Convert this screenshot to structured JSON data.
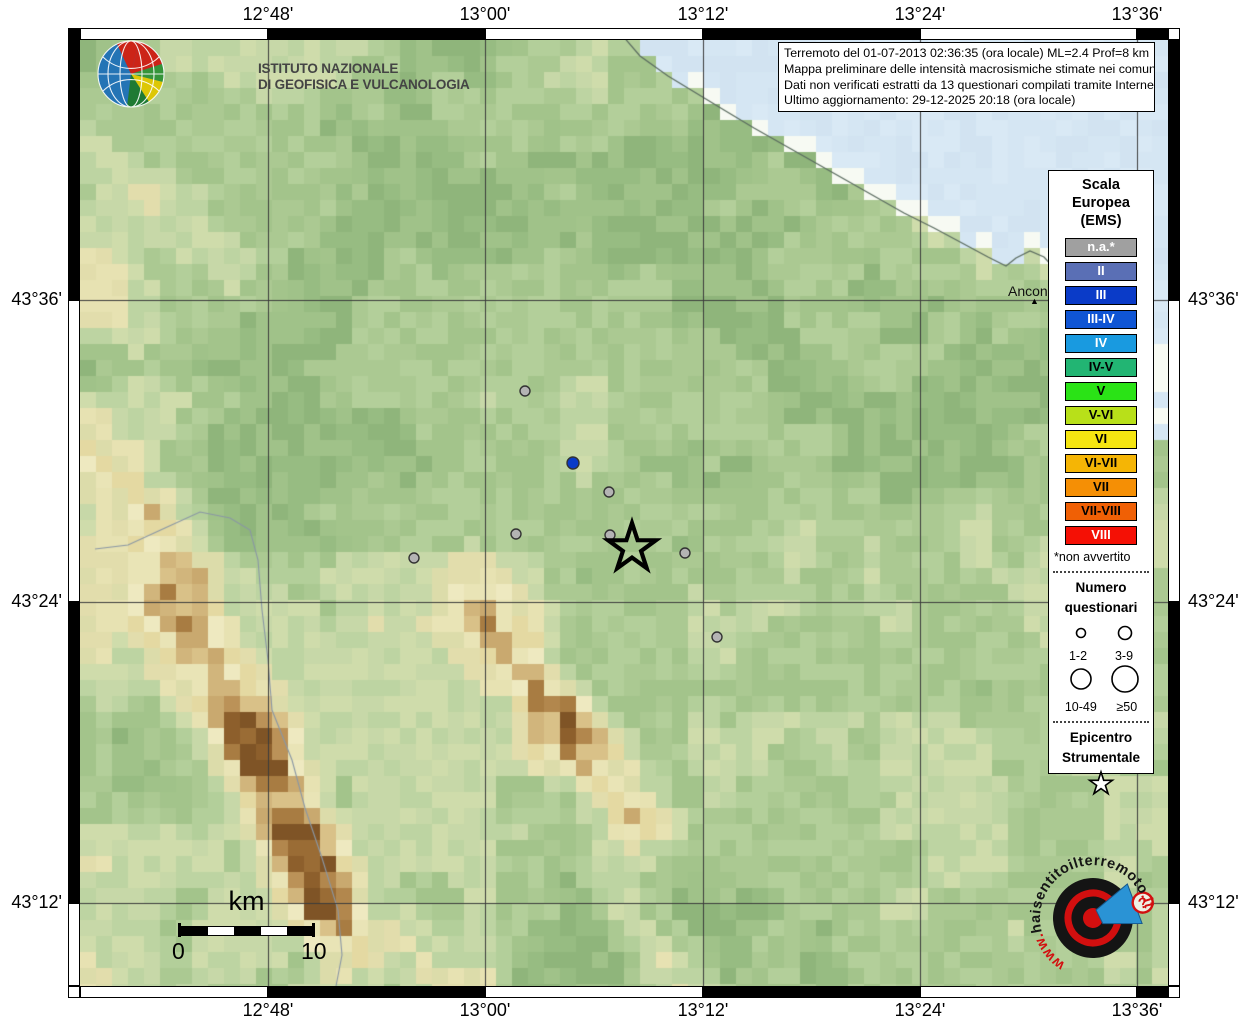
{
  "ingv": {
    "name_line1": "ISTITUTO NAZIONALE",
    "name_line2": "DI GEOFISICA E VULCANOLOGIA"
  },
  "title_box": {
    "lines": [
      "Terremoto del 01-07-2013 02:36:35 (ora locale) ML=2.4 Prof=8 km",
      "Mappa preliminare delle intensità macrosismiche stimate nei comuni",
      "Dati non verificati estratti da 13 questionari compilati tramite Internet.",
      "Ultimo aggiornamento: 29-12-2025 20:18 (ora locale)"
    ]
  },
  "axes": {
    "top": [
      "12°48'",
      "13°00'",
      "13°12'",
      "13°24'",
      "13°36'"
    ],
    "bottom": [
      "12°48'",
      "13°00'",
      "13°12'",
      "13°24'",
      "13°36'"
    ],
    "left": [
      "43°36'",
      "43°24'",
      "43°12'"
    ],
    "right": [
      "43°36'",
      "43°24'",
      "43°12'"
    ]
  },
  "legend": {
    "scale_title": [
      "Scala",
      "Europea",
      "(EMS)"
    ],
    "classes": [
      {
        "label": "n.a.*",
        "color": "#a0a0a0",
        "text": "#ffffff"
      },
      {
        "label": "II",
        "color": "#5a6fb5",
        "text": "#ffffff"
      },
      {
        "label": "III",
        "color": "#0a3bc8",
        "text": "#ffffff"
      },
      {
        "label": "III-IV",
        "color": "#0f55d4",
        "text": "#ffffff"
      },
      {
        "label": "IV",
        "color": "#199ae0",
        "text": "#ffffff"
      },
      {
        "label": "IV-V",
        "color": "#22b573",
        "text": "#000000"
      },
      {
        "label": "V",
        "color": "#2ae316",
        "text": "#000000"
      },
      {
        "label": "V-VI",
        "color": "#b8e019",
        "text": "#000000"
      },
      {
        "label": "VI",
        "color": "#f5e511",
        "text": "#000000"
      },
      {
        "label": "VI-VII",
        "color": "#f5b505",
        "text": "#000000"
      },
      {
        "label": "VII",
        "color": "#f58f05",
        "text": "#000000"
      },
      {
        "label": "VII-VIII",
        "color": "#f06005",
        "text": "#000000"
      },
      {
        "label": "VIII",
        "color": "#f51005",
        "text": "#ffffff"
      }
    ],
    "footnote": "*non avvertito",
    "questionnaires": {
      "title": [
        "Numero",
        "questionari"
      ],
      "sizes": [
        {
          "label": "1-2"
        },
        {
          "label": "3-9"
        },
        {
          "label": "10-49"
        },
        {
          "label": "≥50"
        }
      ]
    },
    "epicenter_title": [
      "Epicentro",
      "Strumentale"
    ]
  },
  "scalebar": {
    "unit": "km",
    "start": "0",
    "end": "10"
  },
  "map_labels": {
    "city": "Ancona"
  },
  "markers": [
    {
      "x": 525,
      "y": 391,
      "class": "na"
    },
    {
      "x": 573,
      "y": 463,
      "class": "III"
    },
    {
      "x": 609,
      "y": 492,
      "class": "na"
    },
    {
      "x": 516,
      "y": 534,
      "class": "na"
    },
    {
      "x": 414,
      "y": 558,
      "class": "na"
    },
    {
      "x": 610,
      "y": 535,
      "class": "na"
    },
    {
      "x": 685,
      "y": 553,
      "class": "na"
    },
    {
      "x": 717,
      "y": 637,
      "class": "na"
    }
  ],
  "epicenter": {
    "x": 632,
    "y": 548
  },
  "watermark": {
    "segments": [
      {
        "t": "www.",
        "c": "#d20f0f"
      },
      {
        "t": "haisentito",
        "c": "#151515"
      },
      {
        "t": "ilterremoto",
        "c": "#151515"
      },
      {
        "t": ".it",
        "c": "#d20f0f"
      }
    ],
    "question_mark": "?"
  }
}
